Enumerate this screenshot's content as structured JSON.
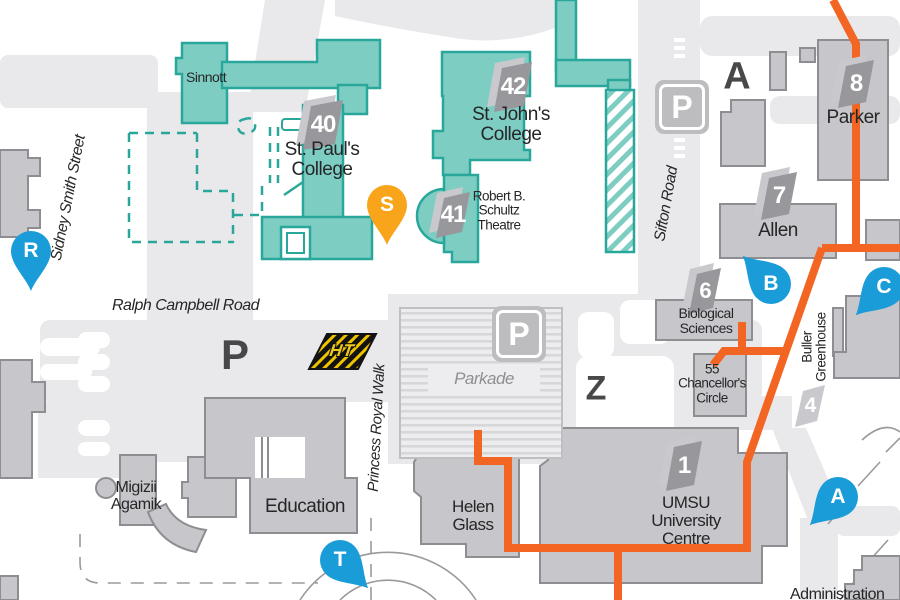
{
  "streets": {
    "sidney_smith": "Sidney Smith Street",
    "ralph_campbell": "Ralph Campbell Road",
    "sifton": "Sifton Road",
    "princess_royal": "Princess Royal Walk"
  },
  "buildings": {
    "sinnott": "Sinnott",
    "st_pauls_1": "St. Paul's",
    "st_pauls_2": "College",
    "st_johns_1": "St. John's",
    "st_johns_2": "College",
    "schultz_1": "Robert B.",
    "schultz_2": "Schultz",
    "schultz_3": "Theatre",
    "parker": "Parker",
    "allen": "Allen",
    "biological_1": "Biological",
    "biological_2": "Sciences",
    "chancellor_1": "55",
    "chancellor_2": "Chancellor's",
    "chancellor_3": "Circle",
    "buller_1": "Buller",
    "buller_2": "Greenhouse",
    "umsu_1": "UMSU",
    "umsu_2": "University",
    "umsu_3": "Centre",
    "helen_1": "Helen",
    "helen_2": "Glass",
    "education": "Education",
    "migizii_1": "Migizii",
    "migizii_2": "Agamik",
    "parkade": "Parkade",
    "admin_partial": "Administration"
  },
  "badges": {
    "b1": "1",
    "b4": "4",
    "b6": "6",
    "b7": "7",
    "b8": "8",
    "b40": "40",
    "b41": "41",
    "b42": "42"
  },
  "zones": {
    "zone_a": "A",
    "lot_p": "P",
    "zone_z": "Z"
  },
  "parking_sign": "P",
  "pins": {
    "s": "S",
    "r": "R",
    "b": "B",
    "c": "C",
    "a": "A",
    "t": "T"
  },
  "markers": {
    "ht": "HT"
  },
  "colors": {
    "teal_fill": "#7ecdc3",
    "teal_stroke": "#2aa79b",
    "building_fill": "#c7c7cb",
    "building_stroke": "#8e8e92",
    "road": "#e9e9eb",
    "route_orange": "#f26522",
    "pin_blue": "#1a9cd8",
    "pin_amber": "#f9a51c",
    "letter_dark": "#48484a",
    "label_text": "#262628",
    "parkade_text": "#8f8f93"
  }
}
